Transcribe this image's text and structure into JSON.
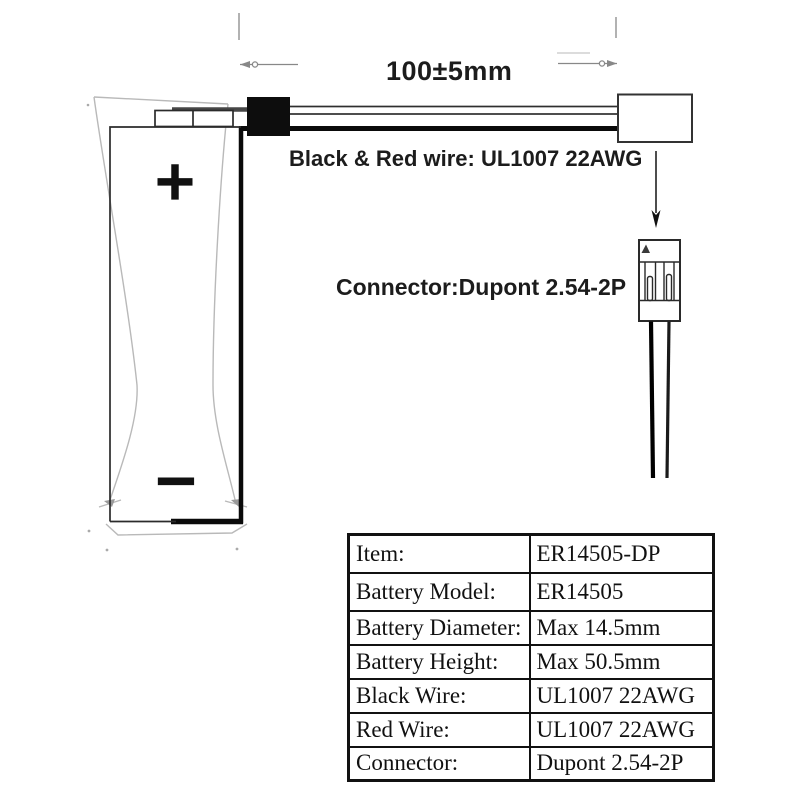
{
  "labels": {
    "dimension": "100±5mm",
    "wire_spec": "Black & Red wire: UL1007 22AWG",
    "connector_spec": "Connector:Dupont 2.54-2P"
  },
  "battery": {
    "positive_symbol": "+",
    "negative_symbol": "−"
  },
  "spec_table": {
    "rows": [
      {
        "label": "Item:",
        "value": "ER14505-DP"
      },
      {
        "label": "Battery Model:",
        "value": "ER14505"
      },
      {
        "label": "Battery Diameter:",
        "value": "Max 14.5mm"
      },
      {
        "label": "Battery Height:",
        "value": "Max 50.5mm"
      },
      {
        "label": "Black Wire:",
        "value": "UL1007 22AWG"
      },
      {
        "label": "Red Wire:",
        "value": "UL1007 22AWG"
      },
      {
        "label": "Connector:",
        "value": "Dupont 2.54-2P"
      }
    ]
  },
  "colors": {
    "ink": "#1a1a1a",
    "ghost_gray": "#b9b9b9",
    "wire_black": "#0a0a0a",
    "background": "#ffffff"
  }
}
